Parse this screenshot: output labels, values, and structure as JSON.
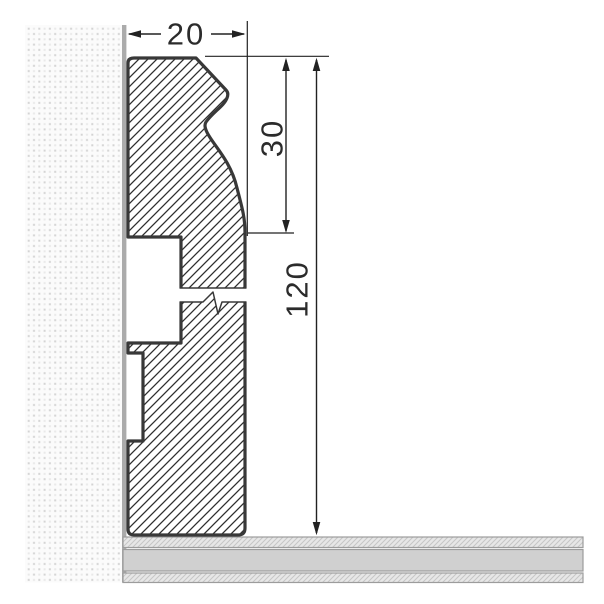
{
  "drawing": {
    "kind": "skirting-board-cross-section",
    "dims": {
      "width": "20",
      "upper_height": "30",
      "total_height": "120"
    },
    "parts": {
      "wall": "wall-section",
      "profile": "skirting-profile",
      "floor": "floor-section",
      "break": "break-symbol"
    },
    "colors": {
      "background": "#ffffff",
      "outline": "#383838",
      "hatch_line": "#2e2e2e",
      "dimension_line": "#222222",
      "dimension_text": "#2b2b2b",
      "wall_dot_dark": "#d4d4d4",
      "wall_dot_light": "#e9e9e9",
      "wall_background": "#fbfbfb",
      "wall_edge": "#ababab",
      "floor_plain_fill": "#d0d0d0",
      "floor_hatch_fill": "#e7e7e7",
      "floor_hatch_line": "#c6c6c6",
      "floor_border": "#9c9c9c"
    }
  }
}
